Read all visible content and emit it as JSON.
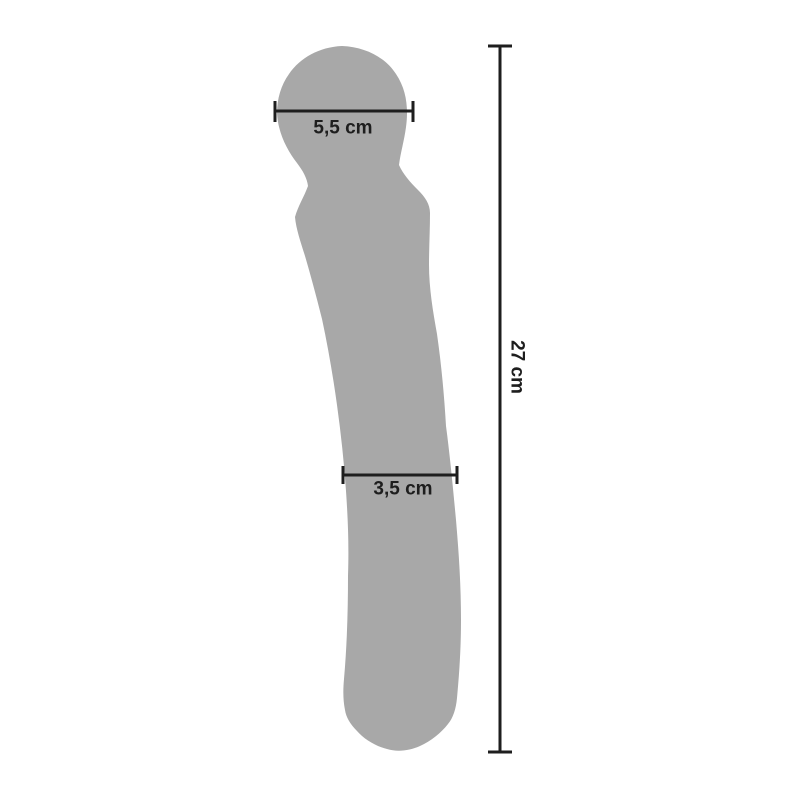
{
  "diagram": {
    "type": "product-dimension-diagram",
    "product": "wand-massager-silhouette",
    "colors": {
      "background": "#ffffff",
      "silhouette-fill": "#a8a8a8",
      "line-color": "#1e1e1e",
      "label-color": "#1e1e1e"
    },
    "measurements": [
      {
        "id": "head-diameter",
        "label": "5,5 cm",
        "value_cm": 5.5,
        "orientation": "horizontal"
      },
      {
        "id": "shaft-diameter",
        "label": "3,5 cm",
        "value_cm": 3.5,
        "orientation": "horizontal"
      },
      {
        "id": "total-length",
        "label": "27 cm",
        "value_cm": 27,
        "orientation": "vertical"
      }
    ]
  }
}
